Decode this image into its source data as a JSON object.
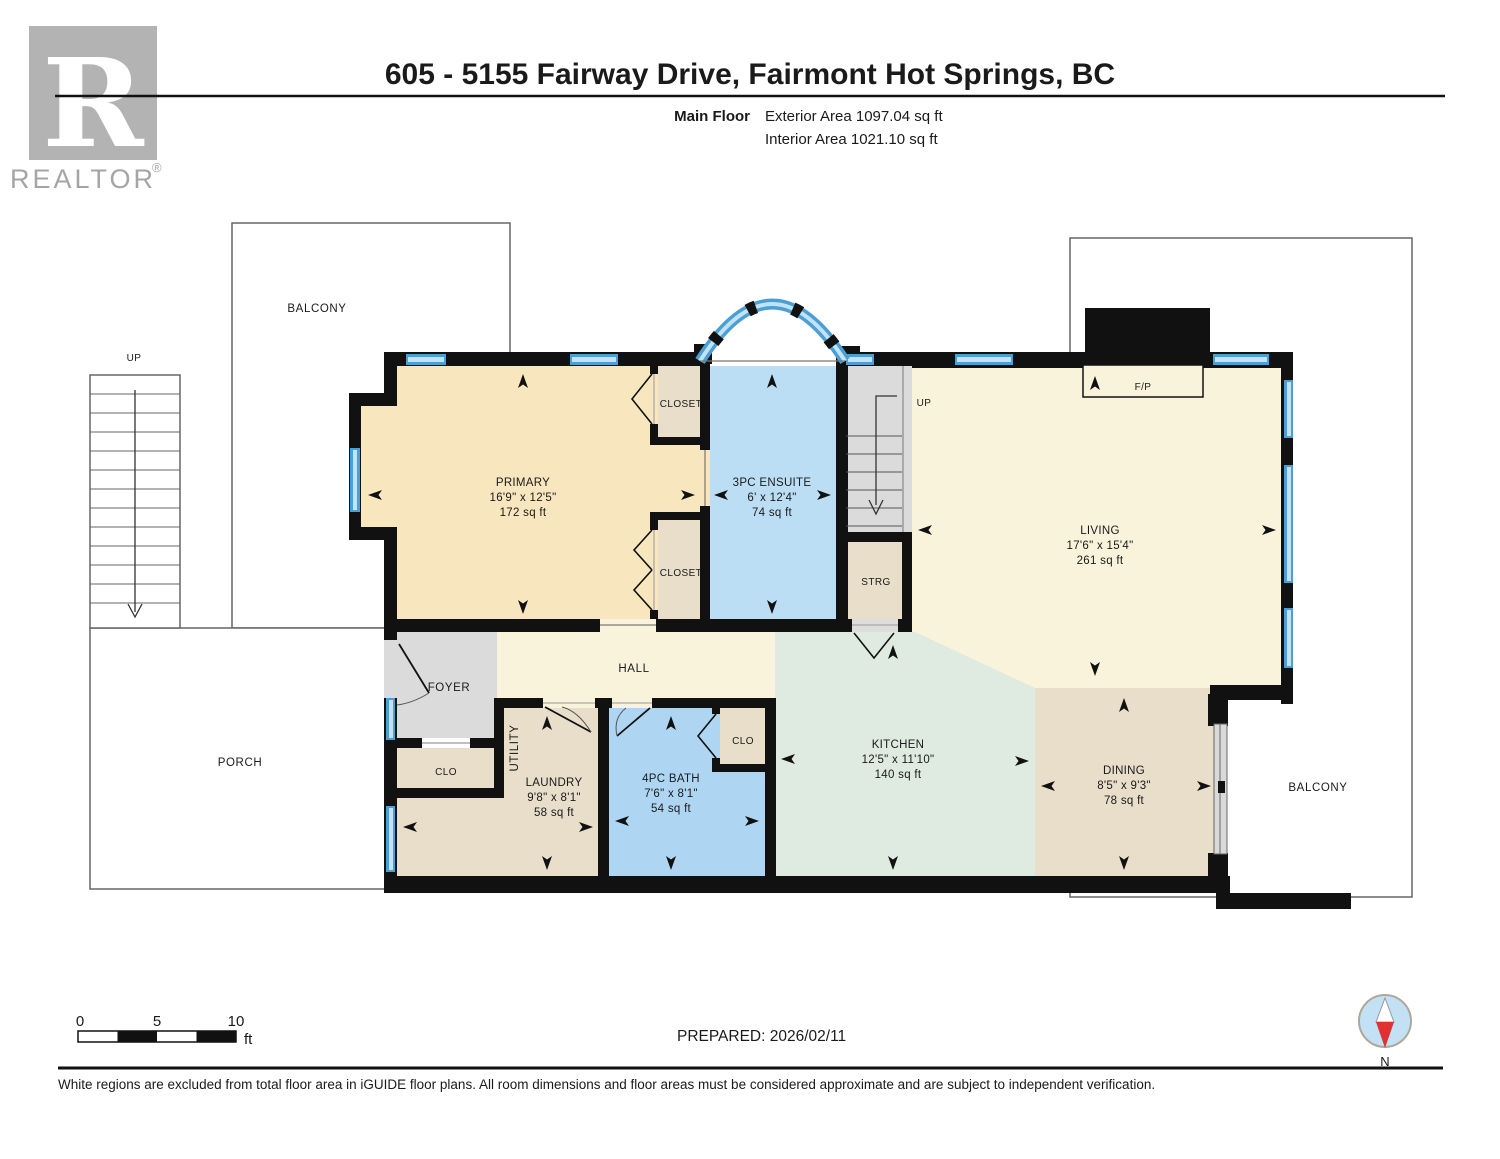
{
  "header": {
    "logo_letter": "R",
    "logo_text": "REALTOR",
    "logo_reg": "®",
    "title": "605 - 5155 Fairway Drive, Fairmont Hot Springs, BC",
    "floor_label": "Main Floor",
    "exterior_area": "Exterior Area 1097.04 sq ft",
    "interior_area": "Interior Area 1021.10 sq ft"
  },
  "rooms": {
    "primary": {
      "name": "PRIMARY",
      "dims": "16'9\" x 12'5\"",
      "area": "172 sq ft"
    },
    "ensuite": {
      "name": "3PC ENSUITE",
      "dims": "6' x 12'4\"",
      "area": "74 sq ft"
    },
    "living": {
      "name": "LIVING",
      "dims": "17'6\" x 15'4\"",
      "area": "261 sq ft"
    },
    "kitchen": {
      "name": "KITCHEN",
      "dims": "12'5\" x 11'10\"",
      "area": "140 sq ft"
    },
    "dining": {
      "name": "DINING",
      "dims": "8'5\" x 9'3\"",
      "area": "78 sq ft"
    },
    "laundry": {
      "name": "LAUNDRY",
      "dims": "9'8\" x 8'1\"",
      "area": "58 sq ft"
    },
    "bath": {
      "name": "4PC BATH",
      "dims": "7'6\" x 8'1\"",
      "area": "54 sq ft"
    }
  },
  "labels": {
    "balcony_top": "BALCONY",
    "balcony_right": "BALCONY",
    "porch": "PORCH",
    "hall": "HALL",
    "foyer": "FOYER",
    "utility": "UTILITY",
    "closet_top": "CLOSET",
    "closet_bottom": "CLOSET",
    "clo_foyer": "CLO",
    "clo_bath": "CLO",
    "strg": "STRG",
    "fireplace": "F/P",
    "up_exterior": "UP",
    "up_interior": "UP"
  },
  "scale_bar": {
    "tick_0": "0",
    "tick_5": "5",
    "tick_10": "10",
    "unit": "ft"
  },
  "compass": {
    "label": "N"
  },
  "footer": {
    "prepared": "PREPARED: 2026/02/11",
    "disclaimer": "White regions are excluded from total floor area in iGUIDE floor plans. All room dimensions and floor areas must be considered approximate and are subject to independent verification."
  },
  "colors": {
    "wall": "#111111",
    "window_blue": "#4D9FD3",
    "window_stripe": "#BFE3F7",
    "room_cream": "#FAF3DC",
    "room_tan": "#F8E7BE",
    "room_beige": "#E8DECA",
    "room_blue_ensuite": "#BCDEF5",
    "room_blue_bath": "#AED6F2",
    "room_green": "#DFEAE1",
    "room_gray": "#DBDBDB",
    "compass_red": "#E03131",
    "compass_blue": "#C3E1F5",
    "logo_gray": "#B3B3B3"
  }
}
